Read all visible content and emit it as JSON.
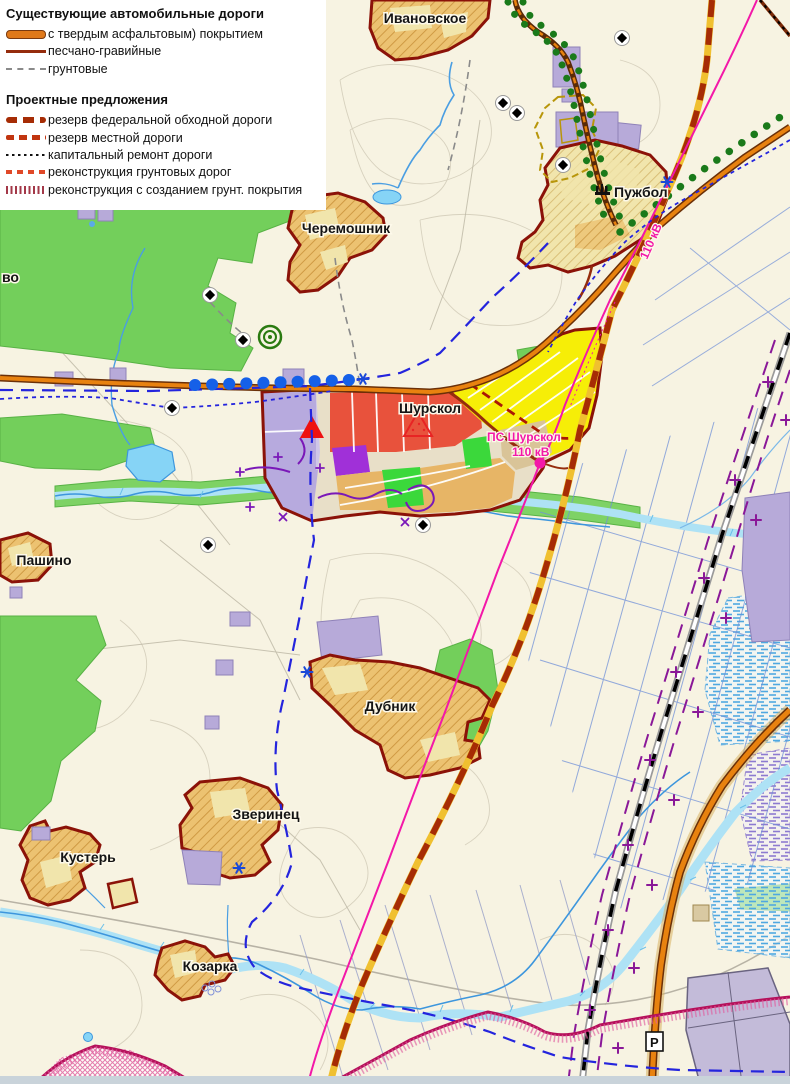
{
  "legend": {
    "existing_title": "Существующие автомобильные дороги",
    "existing_roads": [
      {
        "label": "с твердым асфальтовым) покрытием"
      },
      {
        "label": "песчано-гравийные"
      },
      {
        "label": "грунтовые"
      }
    ],
    "proposals_title": "Проектные предложения",
    "proposals": [
      {
        "label": "резерв федеральной обходной дороги"
      },
      {
        "label": "резерв местной дороги"
      },
      {
        "label": "капитальный ремонт дороги"
      },
      {
        "label": "реконструкция грунтовых дорог"
      },
      {
        "label": "реконструкция с созданием грунт. покрытия"
      }
    ]
  },
  "places": {
    "ivanovskoye": "Ивановское",
    "cheremoshnik": "Черемошник",
    "puzhbol": "Пужбол",
    "shurskol": "Шурскол",
    "pashino": "Пашино",
    "dubnik": "Дубник",
    "zverinets": "Зверинец",
    "kuster": "Кустерь",
    "kozarka": "Козарка",
    "edge_partial_name": "во"
  },
  "annotations": {
    "substation_name": "ПС Шурскол",
    "substation_voltage": "110 кВ",
    "powerline_voltage": "110 кВ",
    "parking_symbol": "P"
  },
  "colors": {
    "asphalt_road": "#e0791a",
    "gravel_road": "#952c0d",
    "federal_reserve": "#a62c05",
    "powerline": "#f318a8",
    "boundary_blue": "#2424dd",
    "railroad": "#000000",
    "forest": "#73cf5b",
    "village_border": "#8b1208",
    "city_limit": "#b5105a"
  }
}
